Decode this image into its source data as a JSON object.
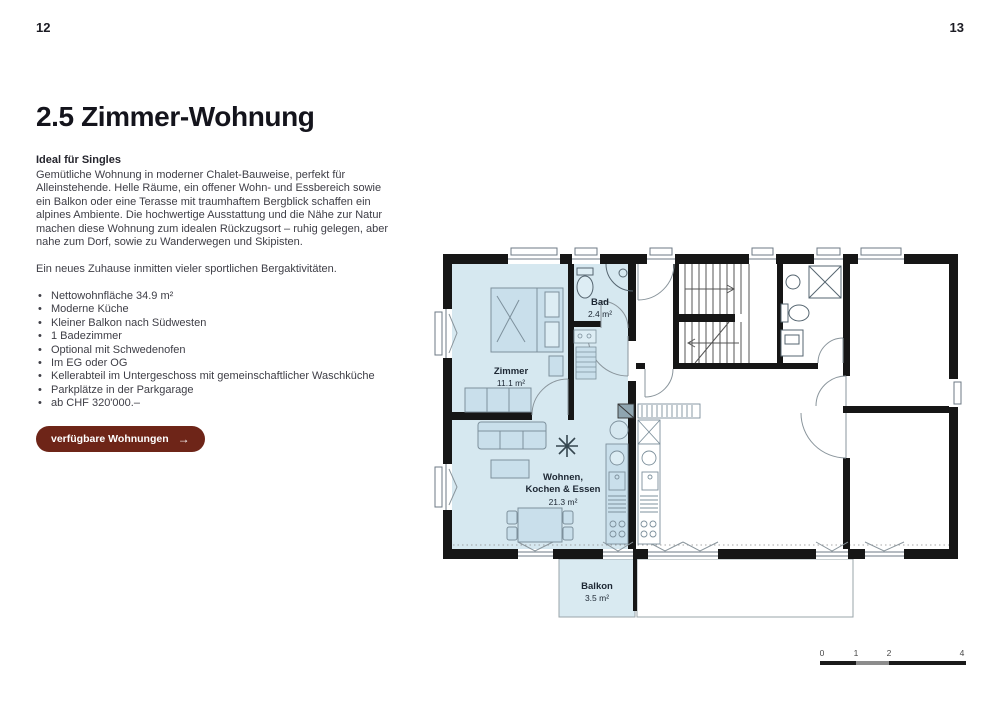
{
  "page": {
    "left_number": "12",
    "right_number": "13"
  },
  "article": {
    "title": "2.5 Zimmer-Wohnung",
    "subtitle": "Ideal für Singles",
    "intro": "Gemütliche Wohnung in moderner Chalet-Bauweise, perfekt für Alleinstehende. Helle Räume, ein offener Wohn- und Essbereich sowie ein Balkon oder eine Terasse mit traumhaftem Bergblick schaffen ein alpines Ambiente. Die hochwertige Ausstattung und die Nähe zur Natur machen diese Wohnung zum idealen Rückzugsort – ruhig gelegen, aber nahe zum Dorf, sowie zu Wanderwegen und Skipisten.",
    "note": "Ein neues Zuhause inmitten vieler sportlichen Bergaktivitäten.",
    "bullets": [
      "Nettowohnfläche 34.9 m²",
      "Moderne Küche",
      "Kleiner Balkon nach Südwesten",
      "1 Badezimmer",
      "Optional mit Schwedenofen",
      "Im EG oder OG",
      "Kellerabteil im Untergeschoss mit gemeinschaftlicher Waschküche",
      "Parkplätze in der Parkgarage",
      "ab CHF 320'000.–"
    ],
    "cta": {
      "label": "verfügbare Wohnungen",
      "arrow": "→"
    }
  },
  "floorplan": {
    "rooms": {
      "zimmer": {
        "name": "Zimmer",
        "area": "11.1 m²"
      },
      "bad": {
        "name": "Bad",
        "area": "2.4 m²"
      },
      "wohnen": {
        "name_line1": "Wohnen,",
        "name_line2": "Kochen & Essen",
        "area": "21.3 m²"
      },
      "balkon": {
        "name": "Balkon",
        "area": "3.5 m²"
      }
    },
    "scale": {
      "ticks": [
        "0",
        "1",
        "2",
        "4"
      ]
    },
    "colors": {
      "highlight": "#d6e8f0",
      "wall": "#161616",
      "accent": "#6e2518"
    }
  }
}
